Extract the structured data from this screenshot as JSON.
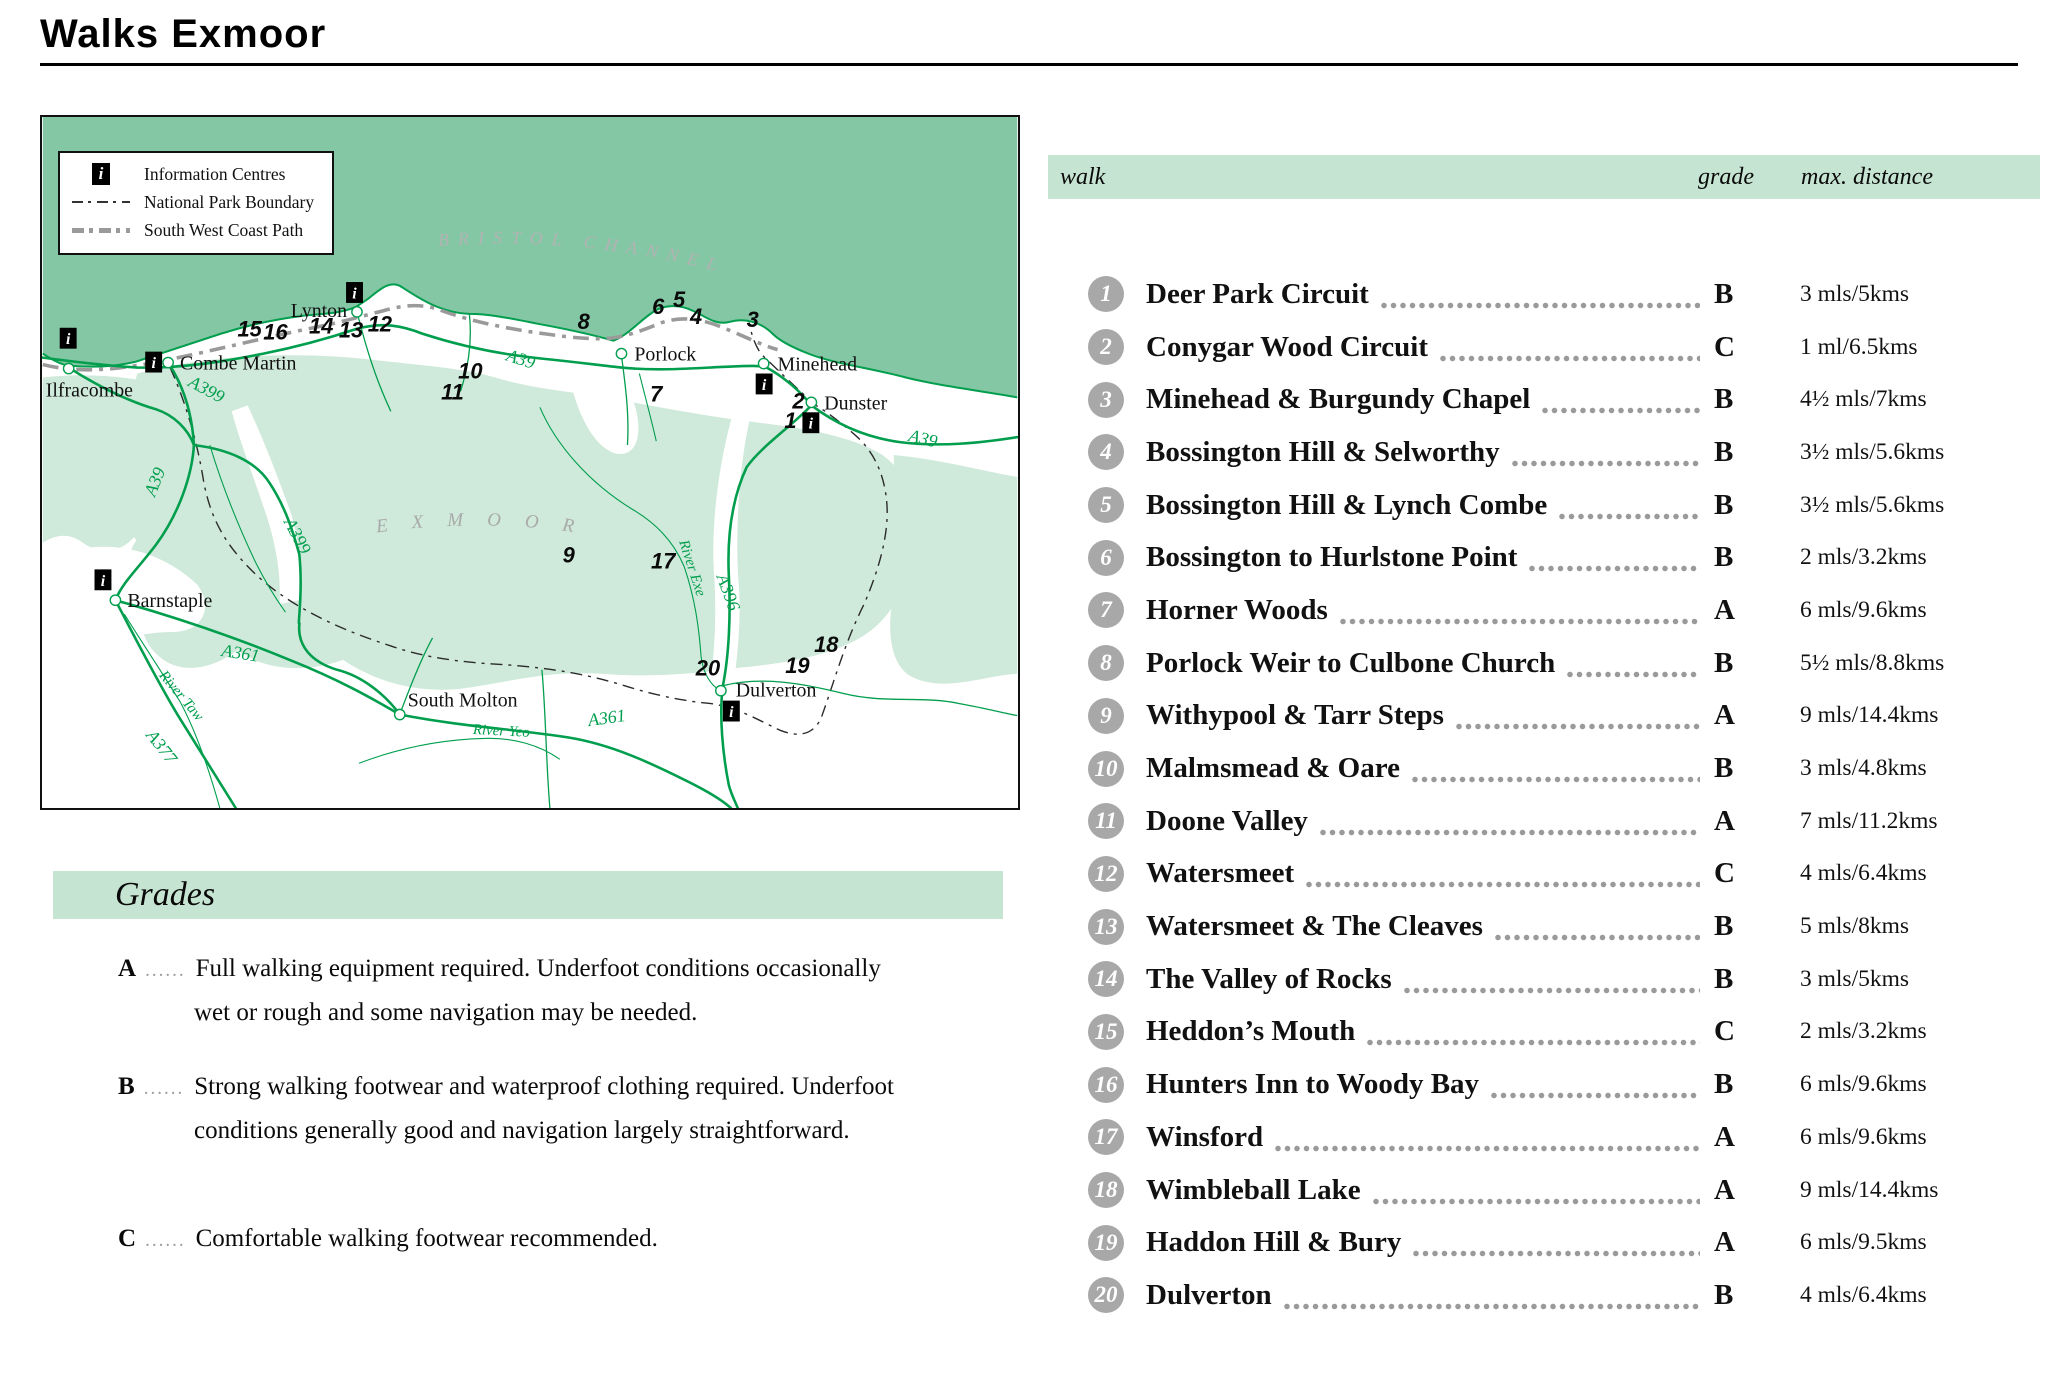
{
  "title": "Walks Exmoor",
  "colors": {
    "sea": "#84c7a5",
    "park": "#cfe9da",
    "road_green": "#009e4d",
    "band_green": "#c6e4d2",
    "badge_gray": "#a8a8a8",
    "coast_path_gray": "#9a9a9a"
  },
  "map": {
    "legend": {
      "info": "Information Centres",
      "boundary": "National Park Boundary",
      "coast_path": "South West Coast Path"
    },
    "sea_label": "BRISTOL CHANNEL",
    "park_label": "EXMOOR",
    "towns": [
      {
        "name": "Ilfracombe",
        "cx": 26,
        "cy": 253,
        "lx": 3,
        "ly": 281,
        "anchor": "start"
      },
      {
        "name": "Combe Martin",
        "cx": 126,
        "cy": 247,
        "lx": 138,
        "ly": 254,
        "anchor": "start"
      },
      {
        "name": "Lynton",
        "cx": 316,
        "cy": 196,
        "lx": 306,
        "ly": 201,
        "anchor": "end"
      },
      {
        "name": "Porlock",
        "cx": 582,
        "cy": 238,
        "lx": 595,
        "ly": 245,
        "anchor": "start"
      },
      {
        "name": "Minehead",
        "cx": 725,
        "cy": 248,
        "lx": 739,
        "ly": 255,
        "anchor": "start"
      },
      {
        "name": "Dunster",
        "cx": 773,
        "cy": 287,
        "lx": 786,
        "ly": 294,
        "anchor": "start"
      },
      {
        "name": "Barnstaple",
        "cx": 73,
        "cy": 486,
        "lx": 85,
        "ly": 493,
        "anchor": "start"
      },
      {
        "name": "South Molton",
        "cx": 359,
        "cy": 601,
        "lx": 367,
        "ly": 593,
        "anchor": "start"
      },
      {
        "name": "Dulverton",
        "cx": 682,
        "cy": 577,
        "lx": 697,
        "ly": 583,
        "anchor": "start"
      }
    ],
    "info_icons": [
      [
        17,
        212
      ],
      [
        103,
        236
      ],
      [
        305,
        166
      ],
      [
        717,
        258
      ],
      [
        764,
        297
      ],
      [
        52,
        455
      ],
      [
        684,
        587
      ]
    ],
    "walk_markers": [
      {
        "n": "1",
        "x": 752,
        "y": 313
      },
      {
        "n": "2",
        "x": 760,
        "y": 293
      },
      {
        "n": "3",
        "x": 714,
        "y": 211
      },
      {
        "n": "4",
        "x": 657,
        "y": 208
      },
      {
        "n": "5",
        "x": 640,
        "y": 191
      },
      {
        "n": "6",
        "x": 619,
        "y": 198
      },
      {
        "n": "7",
        "x": 617,
        "y": 286
      },
      {
        "n": "8",
        "x": 544,
        "y": 213
      },
      {
        "n": "9",
        "x": 529,
        "y": 448
      },
      {
        "n": "10",
        "x": 430,
        "y": 263
      },
      {
        "n": "11",
        "x": 412,
        "y": 284
      },
      {
        "n": "12",
        "x": 339,
        "y": 216
      },
      {
        "n": "13",
        "x": 310,
        "y": 222
      },
      {
        "n": "14",
        "x": 280,
        "y": 218
      },
      {
        "n": "15",
        "x": 208,
        "y": 221
      },
      {
        "n": "16",
        "x": 234,
        "y": 224
      },
      {
        "n": "17",
        "x": 624,
        "y": 454
      },
      {
        "n": "18",
        "x": 788,
        "y": 538
      },
      {
        "n": "19",
        "x": 759,
        "y": 559
      },
      {
        "n": "20",
        "x": 669,
        "y": 562
      }
    ],
    "road_labels": [
      {
        "t": "A39",
        "x": 479,
        "y": 249,
        "r": 18
      },
      {
        "t": "A39",
        "x": 884,
        "y": 329,
        "r": 14
      },
      {
        "t": "A39",
        "x": 118,
        "y": 369,
        "r": -68
      },
      {
        "t": "A399",
        "x": 162,
        "y": 279,
        "r": 28
      },
      {
        "t": "A399",
        "x": 251,
        "y": 424,
        "r": 62
      },
      {
        "t": "A361",
        "x": 198,
        "y": 545,
        "r": 9
      },
      {
        "t": "A361",
        "x": 568,
        "y": 610,
        "r": -8
      },
      {
        "t": "A377",
        "x": 115,
        "y": 637,
        "r": 52
      },
      {
        "t": "A396",
        "x": 684,
        "y": 480,
        "r": 70
      }
    ],
    "river_labels": [
      {
        "t": "River Taw",
        "x": 136,
        "y": 585,
        "r": 50
      },
      {
        "t": "River Yeo",
        "x": 461,
        "y": 622,
        "r": 3
      },
      {
        "t": "River Exe",
        "x": 649,
        "y": 455,
        "r": 72
      }
    ]
  },
  "grades": {
    "heading": "Grades",
    "items": [
      {
        "letter": "A",
        "dots": "......",
        "text": "Full walking equipment required.  Underfoot conditions occasionally wet or rough and some navigation may be needed."
      },
      {
        "letter": "B",
        "dots": "......",
        "text": "Strong walking footwear and waterproof clothing required. Underfoot conditions generally good and navigation largely straightforward."
      },
      {
        "letter": "C",
        "dots": "......",
        "text": "Comfortable walking footwear recommended."
      }
    ]
  },
  "walks_table": {
    "headers": {
      "walk": "walk",
      "grade": "grade",
      "distance": "max. distance"
    },
    "rows": [
      {
        "num": "1",
        "name": "Deer Park Circuit",
        "grade": "B",
        "distance": "3 mls/5kms"
      },
      {
        "num": "2",
        "name": "Conygar Wood Circuit",
        "grade": "C",
        "distance": "1 ml/6.5kms"
      },
      {
        "num": "3",
        "name": "Minehead & Burgundy Chapel",
        "grade": "B",
        "distance": "4½ mls/7kms"
      },
      {
        "num": "4",
        "name": "Bossington Hill & Selworthy",
        "grade": "B",
        "distance": "3½ mls/5.6kms"
      },
      {
        "num": "5",
        "name": "Bossington Hill & Lynch Combe",
        "grade": "B",
        "distance": "3½ mls/5.6kms"
      },
      {
        "num": "6",
        "name": "Bossington to Hurlstone Point",
        "grade": "B",
        "distance": "2 mls/3.2kms"
      },
      {
        "num": "7",
        "name": "Horner Woods",
        "grade": "A",
        "distance": "6 mls/9.6kms"
      },
      {
        "num": "8",
        "name": "Porlock Weir to Culbone Church",
        "grade": "B",
        "distance": "5½ mls/8.8kms"
      },
      {
        "num": "9",
        "name": "Withypool & Tarr Steps",
        "grade": "A",
        "distance": "9 mls/14.4kms"
      },
      {
        "num": "10",
        "name": "Malmsmead & Oare",
        "grade": "B",
        "distance": "3 mls/4.8kms"
      },
      {
        "num": "11",
        "name": "Doone Valley",
        "grade": "A",
        "distance": "7 mls/11.2kms"
      },
      {
        "num": "12",
        "name": "Watersmeet",
        "grade": "C",
        "distance": "4 mls/6.4kms"
      },
      {
        "num": "13",
        "name": "Watersmeet & The Cleaves",
        "grade": "B",
        "distance": "5 mls/8kms"
      },
      {
        "num": "14",
        "name": "The Valley of Rocks",
        "grade": "B",
        "distance": "3 mls/5kms"
      },
      {
        "num": "15",
        "name": "Heddon’s Mouth",
        "grade": "C",
        "distance": "2 mls/3.2kms"
      },
      {
        "num": "16",
        "name": "Hunters Inn to Woody Bay",
        "grade": "B",
        "distance": "6 mls/9.6kms"
      },
      {
        "num": "17",
        "name": "Winsford",
        "grade": "A",
        "distance": "6 mls/9.6kms"
      },
      {
        "num": "18",
        "name": "Wimbleball Lake",
        "grade": "A",
        "distance": "9 mls/14.4kms"
      },
      {
        "num": "19",
        "name": "Haddon Hill & Bury",
        "grade": "A",
        "distance": "6 mls/9.5kms"
      },
      {
        "num": "20",
        "name": "Dulverton",
        "grade": "B",
        "distance": "4 mls/6.4kms"
      }
    ]
  }
}
